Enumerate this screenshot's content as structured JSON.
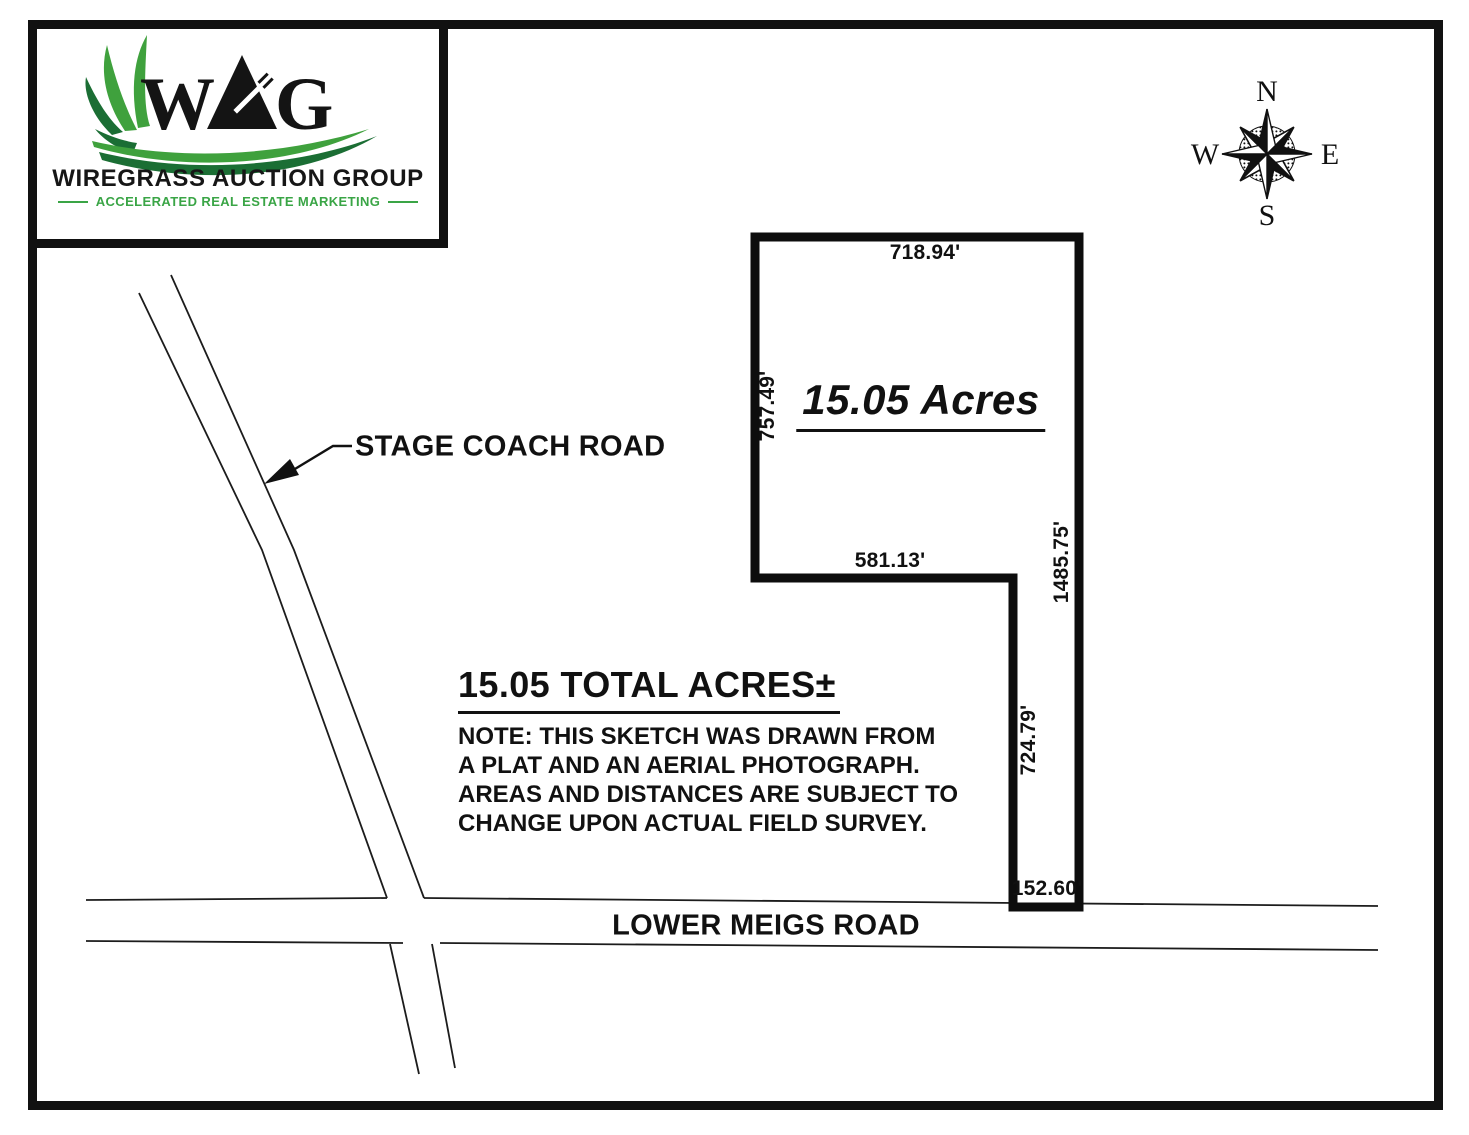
{
  "page": {
    "background": "#ffffff",
    "ink": "#111111"
  },
  "logo": {
    "letters": {
      "w": "W",
      "a": "A",
      "g": "G"
    },
    "name": "WIREGRASS AUCTION GROUP",
    "tagline": "ACCELERATED REAL ESTATE MARKETING",
    "colors": {
      "light_green": "#3fa13d",
      "dark_green": "#1b6e34",
      "tagline_green": "#3aa546"
    }
  },
  "compass": {
    "north": "N",
    "east": "E",
    "south": "S",
    "west": "W"
  },
  "parcel": {
    "area_label": "15.05 Acres",
    "dims": {
      "top": "718.94'",
      "left": "757.49'",
      "inner": "581.13'",
      "right": "1485.75'",
      "strip": "724.79'",
      "bottom": "152.60'"
    }
  },
  "roads": {
    "stage_coach": "STAGE COACH ROAD",
    "lower_meigs": "LOWER MEIGS ROAD"
  },
  "summary": {
    "title": "15.05 TOTAL ACRES±",
    "notes": [
      "NOTE: THIS SKETCH WAS DRAWN FROM",
      "A PLAT AND AN AERIAL PHOTOGRAPH.",
      "AREAS AND DISTANCES ARE SUBJECT TO",
      "CHANGE UPON ACTUAL FIELD SURVEY."
    ]
  }
}
